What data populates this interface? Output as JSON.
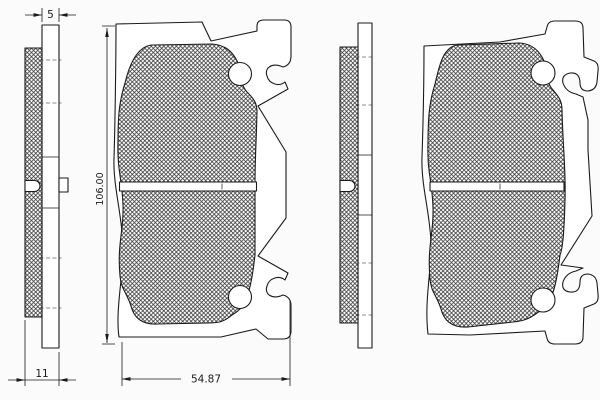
{
  "drawing": {
    "dimensions": {
      "friction_thickness": "5",
      "total_thickness": "11",
      "pad_height": "106.00",
      "pad_width": "54.87"
    },
    "colors": {
      "line": "#1b1b1b",
      "background": "#fbfbfb"
    }
  }
}
